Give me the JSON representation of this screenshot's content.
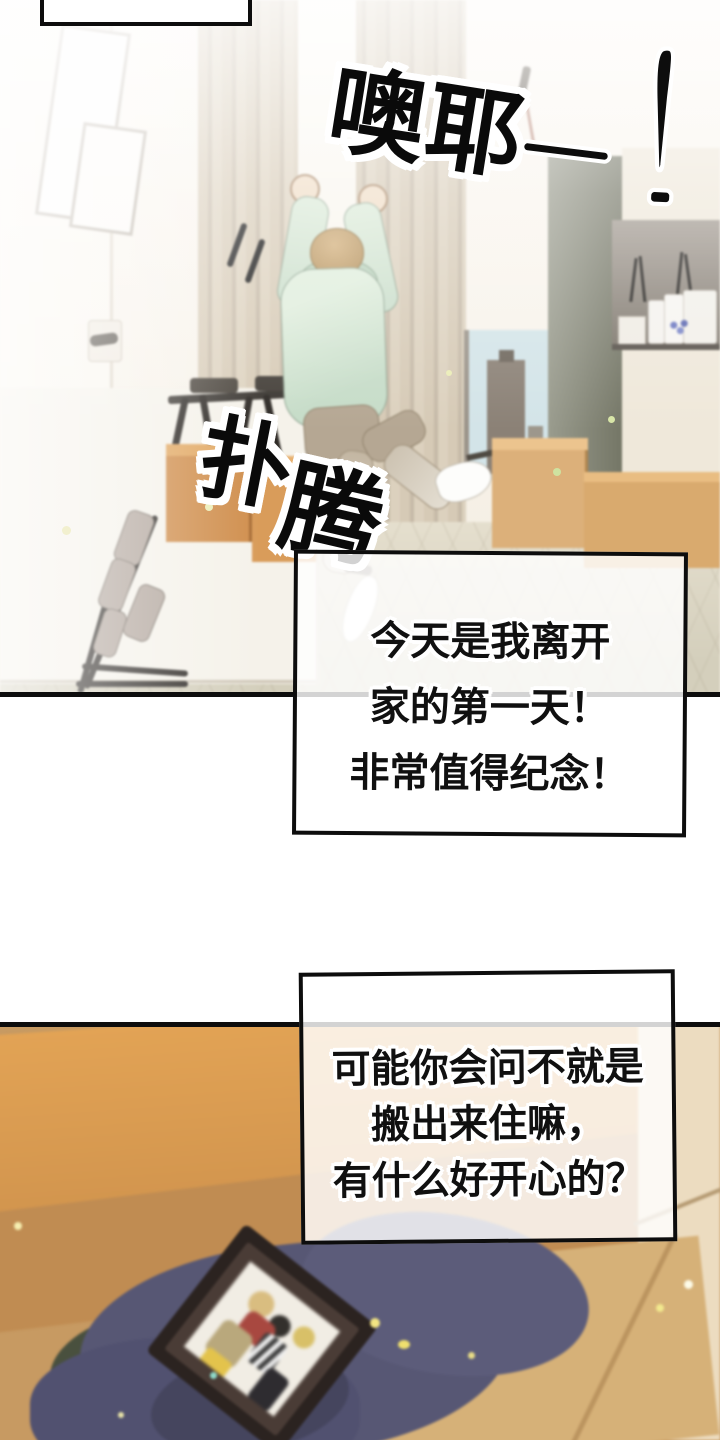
{
  "sfx": {
    "cheer": "噢耶",
    "cheer_dash": "—",
    "exclamation": "!",
    "flutter_first": "扑",
    "flutter_second": "腾"
  },
  "narration": {
    "box1": {
      "lines": [
        "今天是我离开",
        "家的第一天！",
        "非常值得纪念！"
      ]
    },
    "box2": {
      "lines": [
        "可能你会问不就是",
        "搬出来住嘛，",
        "有什么好开心的？"
      ]
    }
  },
  "palette": {
    "ink": "#0d0d0d",
    "panel_bg": "#f8f3ec",
    "mint_hoodie": "#d6e7d8",
    "hair": "#c7a26e",
    "curtain": "#d2c6b2",
    "window_sky": "#d3e4e8",
    "floor": "#ddd7c5",
    "cardboard_orange": "#d08f4e",
    "cloth_navy": "#565672",
    "frame_wood": "#2b2320",
    "sparkle_yellow": "#efe48b"
  }
}
